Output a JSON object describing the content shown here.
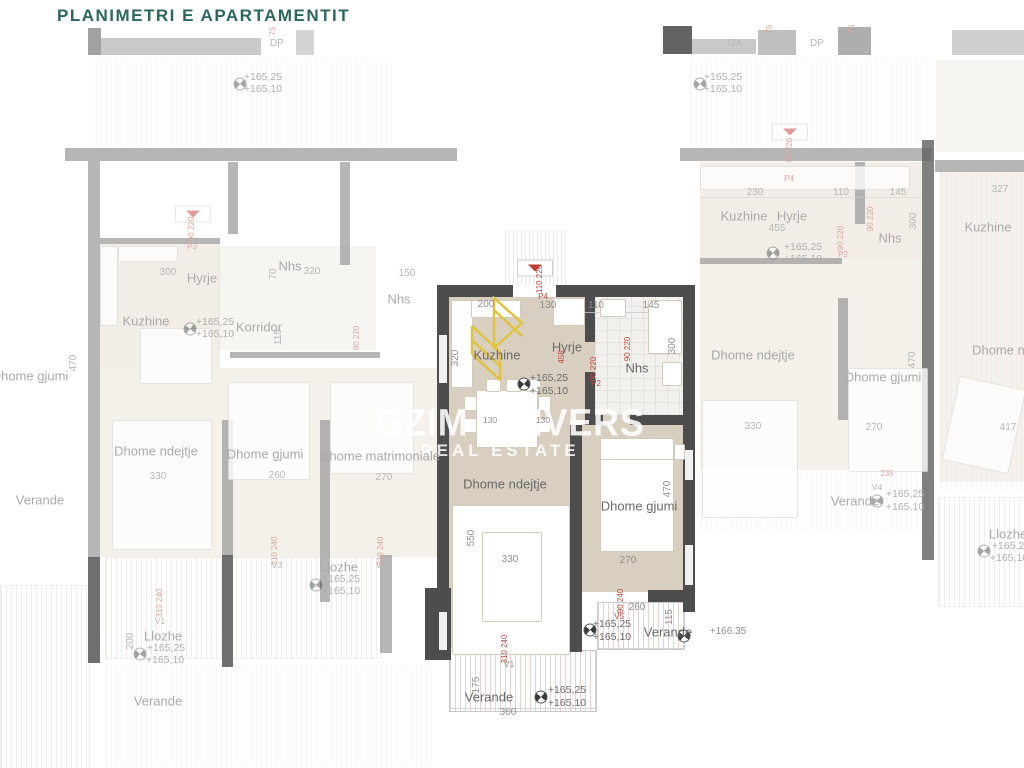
{
  "title": "PLANIMETRI  E  APARTAMENTIT",
  "watermark": {
    "brand": "GZIM UNIVERS",
    "tagline": "REAL ESTATE"
  },
  "icons": {
    "compass": "level-marker-icon",
    "entrance": "entrance-door-marker"
  },
  "colors": {
    "title": "#2a675f",
    "wall": "#4d4d4d",
    "floor": "#d9cfc0",
    "accent_red": "#bf4a42",
    "logo_yellow": "#dfc33e"
  },
  "labels": [
    {
      "t": "DP",
      "x": 277,
      "y": 44,
      "c": "dim f"
    },
    {
      "t": "DA",
      "x": 735,
      "y": 44,
      "c": "dim f"
    },
    {
      "t": "DP",
      "x": 817,
      "y": 44,
      "c": "dim f"
    },
    {
      "t": "75",
      "x": 273,
      "y": 31,
      "c": "red f r"
    },
    {
      "t": "75",
      "x": 770,
      "y": 29,
      "c": "red f r"
    },
    {
      "t": "75",
      "x": 852,
      "y": 29,
      "c": "red f r"
    },
    {
      "t": "+165,25",
      "x": 263,
      "y": 77,
      "c": "elev f"
    },
    {
      "t": "+165,10",
      "x": 263,
      "y": 89,
      "c": "elev f"
    },
    {
      "t": "+165,25",
      "x": 723,
      "y": 77,
      "c": "elev f"
    },
    {
      "t": "+165,10",
      "x": 723,
      "y": 89,
      "c": "elev f"
    },
    {
      "t": "Hyrje",
      "x": 202,
      "y": 278,
      "c": "room f"
    },
    {
      "t": "300",
      "x": 168,
      "y": 273,
      "c": "dim f"
    },
    {
      "t": "Nhs",
      "x": 290,
      "y": 266,
      "c": "room f"
    },
    {
      "t": "320",
      "x": 312,
      "y": 272,
      "c": "dim f"
    },
    {
      "t": "70",
      "x": 274,
      "y": 274,
      "c": "dim f r"
    },
    {
      "t": "150",
      "x": 407,
      "y": 274,
      "c": "dim f"
    },
    {
      "t": "Nhs",
      "x": 399,
      "y": 299,
      "c": "room f"
    },
    {
      "t": "Kuzhine",
      "x": 146,
      "y": 321,
      "c": "room f"
    },
    {
      "t": "+165,25",
      "x": 215,
      "y": 322,
      "c": "elev f"
    },
    {
      "t": "+165,10",
      "x": 215,
      "y": 334,
      "c": "elev f"
    },
    {
      "t": "Korridor",
      "x": 259,
      "y": 327,
      "c": "room f"
    },
    {
      "t": "115",
      "x": 279,
      "y": 337,
      "c": "dim f r"
    },
    {
      "t": "90 220",
      "x": 357,
      "y": 338,
      "c": "red f r"
    },
    {
      "t": "90 220",
      "x": 192,
      "y": 229,
      "c": "red f r"
    },
    {
      "t": "P3",
      "x": 192,
      "y": 247,
      "c": "red f"
    },
    {
      "t": "Dhome gjumi",
      "x": 30,
      "y": 376,
      "c": "room f"
    },
    {
      "t": "470",
      "x": 74,
      "y": 363,
      "c": "dim f r"
    },
    {
      "t": "Verande",
      "x": 40,
      "y": 500,
      "c": "room f"
    },
    {
      "t": "Dhome ndejtje",
      "x": 156,
      "y": 451,
      "c": "room f"
    },
    {
      "t": "330",
      "x": 158,
      "y": 477,
      "c": "dim f"
    },
    {
      "t": "Dhome gjumi",
      "x": 265,
      "y": 454,
      "c": "room f"
    },
    {
      "t": "260",
      "x": 277,
      "y": 476,
      "c": "dim f"
    },
    {
      "t": "Dhome matrimoniale",
      "x": 380,
      "y": 456,
      "c": "room f"
    },
    {
      "t": "270",
      "x": 384,
      "y": 478,
      "c": "dim f"
    },
    {
      "t": "Llozhe",
      "x": 339,
      "y": 567,
      "c": "room f"
    },
    {
      "t": "+165,25",
      "x": 341,
      "y": 579,
      "c": "elev f"
    },
    {
      "t": "+165,10",
      "x": 341,
      "y": 591,
      "c": "elev f"
    },
    {
      "t": "V3",
      "x": 277,
      "y": 565,
      "c": "dim f sm"
    },
    {
      "t": "310 240",
      "x": 275,
      "y": 551,
      "c": "red f r"
    },
    {
      "t": "310 240",
      "x": 381,
      "y": 551,
      "c": "red f r"
    },
    {
      "t": "V3",
      "x": 381,
      "y": 565,
      "c": "dim f sm"
    },
    {
      "t": "V1",
      "x": 160,
      "y": 621,
      "c": "dim f sm"
    },
    {
      "t": "310 240",
      "x": 160,
      "y": 603,
      "c": "red f r"
    },
    {
      "t": "200",
      "x": 131,
      "y": 641,
      "c": "dim f r"
    },
    {
      "t": "Llozhe",
      "x": 163,
      "y": 636,
      "c": "room f"
    },
    {
      "t": "+165,25",
      "x": 166,
      "y": 648,
      "c": "elev f"
    },
    {
      "t": "+165,10",
      "x": 165,
      "y": 660,
      "c": "elev f"
    },
    {
      "t": "Verande",
      "x": 158,
      "y": 701,
      "c": "room f"
    },
    {
      "t": "110 220",
      "x": 540,
      "y": 279,
      "c": "red r"
    },
    {
      "t": "200",
      "x": 486,
      "y": 305,
      "c": "dim"
    },
    {
      "t": "P4",
      "x": 543,
      "y": 297,
      "c": "red"
    },
    {
      "t": "130",
      "x": 548,
      "y": 306,
      "c": "dim"
    },
    {
      "t": "110",
      "x": 596,
      "y": 306,
      "c": "dim"
    },
    {
      "t": "145",
      "x": 651,
      "y": 306,
      "c": "dim"
    },
    {
      "t": "320",
      "x": 456,
      "y": 358,
      "c": "dim r"
    },
    {
      "t": "Kuzhine",
      "x": 497,
      "y": 355,
      "c": "room"
    },
    {
      "t": "Hyrje",
      "x": 567,
      "y": 347,
      "c": "room"
    },
    {
      "t": "455",
      "x": 562,
      "y": 357,
      "c": "red r"
    },
    {
      "t": "90 220",
      "x": 594,
      "y": 369,
      "c": "red r"
    },
    {
      "t": "P2",
      "x": 596,
      "y": 384,
      "c": "red"
    },
    {
      "t": "90 220",
      "x": 628,
      "y": 349,
      "c": "red r"
    },
    {
      "t": "Nhs",
      "x": 637,
      "y": 368,
      "c": "room"
    },
    {
      "t": "300",
      "x": 673,
      "y": 346,
      "c": "dim r"
    },
    {
      "t": "+165,25",
      "x": 549,
      "y": 378,
      "c": "elev"
    },
    {
      "t": "+165,10",
      "x": 549,
      "y": 391,
      "c": "elev"
    },
    {
      "t": "130",
      "x": 490,
      "y": 420,
      "c": "dim sm"
    },
    {
      "t": "130",
      "x": 543,
      "y": 420,
      "c": "dim sm"
    },
    {
      "t": "Dhome ndejtje",
      "x": 505,
      "y": 484,
      "c": "room"
    },
    {
      "t": "550",
      "x": 472,
      "y": 538,
      "c": "dim r"
    },
    {
      "t": "330",
      "x": 510,
      "y": 560,
      "c": "dim"
    },
    {
      "t": "Dhome gjumi",
      "x": 639,
      "y": 506,
      "c": "room"
    },
    {
      "t": "470",
      "x": 668,
      "y": 489,
      "c": "dim r"
    },
    {
      "t": "270",
      "x": 628,
      "y": 561,
      "c": "dim"
    },
    {
      "t": "90 240",
      "x": 621,
      "y": 601,
      "c": "red r"
    },
    {
      "t": "260",
      "x": 637,
      "y": 608,
      "c": "dim"
    },
    {
      "t": "V5",
      "x": 619,
      "y": 617,
      "c": "red sm"
    },
    {
      "t": "+165,25",
      "x": 612,
      "y": 624,
      "c": "elev"
    },
    {
      "t": "+165,10",
      "x": 612,
      "y": 637,
      "c": "elev"
    },
    {
      "t": "Verande",
      "x": 668,
      "y": 632,
      "c": "room"
    },
    {
      "t": "115",
      "x": 670,
      "y": 617,
      "c": "dim r"
    },
    {
      "t": "+166.35",
      "x": 728,
      "y": 632,
      "c": "dim"
    },
    {
      "t": "V1",
      "x": 509,
      "y": 664,
      "c": "dim sm"
    },
    {
      "t": "310 240",
      "x": 505,
      "y": 649,
      "c": "red r"
    },
    {
      "t": "175",
      "x": 477,
      "y": 685,
      "c": "dim r"
    },
    {
      "t": "Verande",
      "x": 489,
      "y": 697,
      "c": "room"
    },
    {
      "t": "+165,25",
      "x": 567,
      "y": 690,
      "c": "elev"
    },
    {
      "t": "+165,10",
      "x": 567,
      "y": 703,
      "c": "elev"
    },
    {
      "t": "360",
      "x": 508,
      "y": 713,
      "c": "dim"
    },
    {
      "t": "90 220",
      "x": 790,
      "y": 150,
      "c": "red f r"
    },
    {
      "t": "P4",
      "x": 789,
      "y": 179,
      "c": "red f"
    },
    {
      "t": "230",
      "x": 755,
      "y": 193,
      "c": "dim f"
    },
    {
      "t": "110",
      "x": 841,
      "y": 193,
      "c": "dim f"
    },
    {
      "t": "145",
      "x": 898,
      "y": 193,
      "c": "dim f"
    },
    {
      "t": "327",
      "x": 1000,
      "y": 190,
      "c": "dim f"
    },
    {
      "t": "Kuzhine",
      "x": 744,
      "y": 216,
      "c": "room f"
    },
    {
      "t": "Hyrje",
      "x": 792,
      "y": 216,
      "c": "room f"
    },
    {
      "t": "455",
      "x": 777,
      "y": 229,
      "c": "dim f"
    },
    {
      "t": "+165,25",
      "x": 803,
      "y": 247,
      "c": "elev f"
    },
    {
      "t": "+165,10",
      "x": 803,
      "y": 259,
      "c": "elev f"
    },
    {
      "t": "Nhs",
      "x": 890,
      "y": 238,
      "c": "room f"
    },
    {
      "t": "90 220",
      "x": 871,
      "y": 219,
      "c": "red f r"
    },
    {
      "t": "300",
      "x": 914,
      "y": 221,
      "c": "dim f r"
    },
    {
      "t": "P2",
      "x": 843,
      "y": 255,
      "c": "red f"
    },
    {
      "t": "90 220",
      "x": 841,
      "y": 238,
      "c": "red f r"
    },
    {
      "t": "Kuzhine",
      "x": 988,
      "y": 227,
      "c": "room f"
    },
    {
      "t": "Dhome ndejtje",
      "x": 753,
      "y": 355,
      "c": "room f"
    },
    {
      "t": "330",
      "x": 753,
      "y": 427,
      "c": "dim f"
    },
    {
      "t": "Dhome gjumi",
      "x": 883,
      "y": 377,
      "c": "room f"
    },
    {
      "t": "270",
      "x": 874,
      "y": 428,
      "c": "dim f"
    },
    {
      "t": "470",
      "x": 913,
      "y": 360,
      "c": "dim f r"
    },
    {
      "t": "Dhome ndejtje",
      "x": 1014,
      "y": 350,
      "c": "room f"
    },
    {
      "t": "417",
      "x": 1008,
      "y": 428,
      "c": "dim f"
    },
    {
      "t": "235",
      "x": 887,
      "y": 474,
      "c": "red f"
    },
    {
      "t": "V4",
      "x": 877,
      "y": 487,
      "c": "dim f sm"
    },
    {
      "t": "Verande",
      "x": 855,
      "y": 501,
      "c": "room f"
    },
    {
      "t": "+165,25",
      "x": 905,
      "y": 494,
      "c": "elev f"
    },
    {
      "t": "+165,10",
      "x": 905,
      "y": 507,
      "c": "elev f"
    },
    {
      "t": "Llozhe",
      "x": 1008,
      "y": 534,
      "c": "room f"
    },
    {
      "t": "+165,25",
      "x": 1011,
      "y": 546,
      "c": "elev f"
    },
    {
      "t": "+165,10",
      "x": 1009,
      "y": 558,
      "c": "elev f"
    }
  ]
}
